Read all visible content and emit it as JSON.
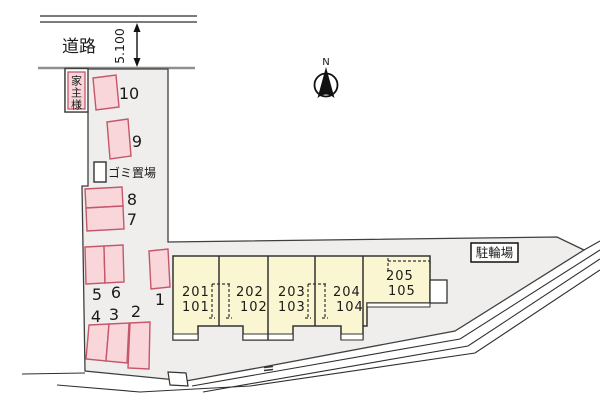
{
  "plan": {
    "road_label": "道路",
    "dimension_label": "5.100",
    "north_label": "N",
    "landlord_label": "家主様",
    "garbage_label": "ゴミ置場",
    "bicycle_label": "駐輪場",
    "stalls": [
      {
        "label": "1"
      },
      {
        "label": "2"
      },
      {
        "label": "3"
      },
      {
        "label": "4"
      },
      {
        "label": "5"
      },
      {
        "label": "6"
      },
      {
        "label": "7"
      },
      {
        "label": "8"
      },
      {
        "label": "9"
      },
      {
        "label": "10"
      }
    ],
    "units": [
      {
        "upper": "201",
        "lower": "101"
      },
      {
        "upper": "202",
        "lower": "102"
      },
      {
        "upper": "203",
        "lower": "103"
      },
      {
        "upper": "204",
        "lower": "104"
      },
      {
        "upper": "205",
        "lower": "105"
      }
    ],
    "colors": {
      "site_fill": "#f0eeec",
      "stall_fill": "#f8d6da",
      "stall_stroke": "#c4576a",
      "building_fill": "#fbf6d2",
      "boundary": "#3f3f3f",
      "road_line": "#2f2f2f",
      "top_fence": "#909090"
    }
  }
}
